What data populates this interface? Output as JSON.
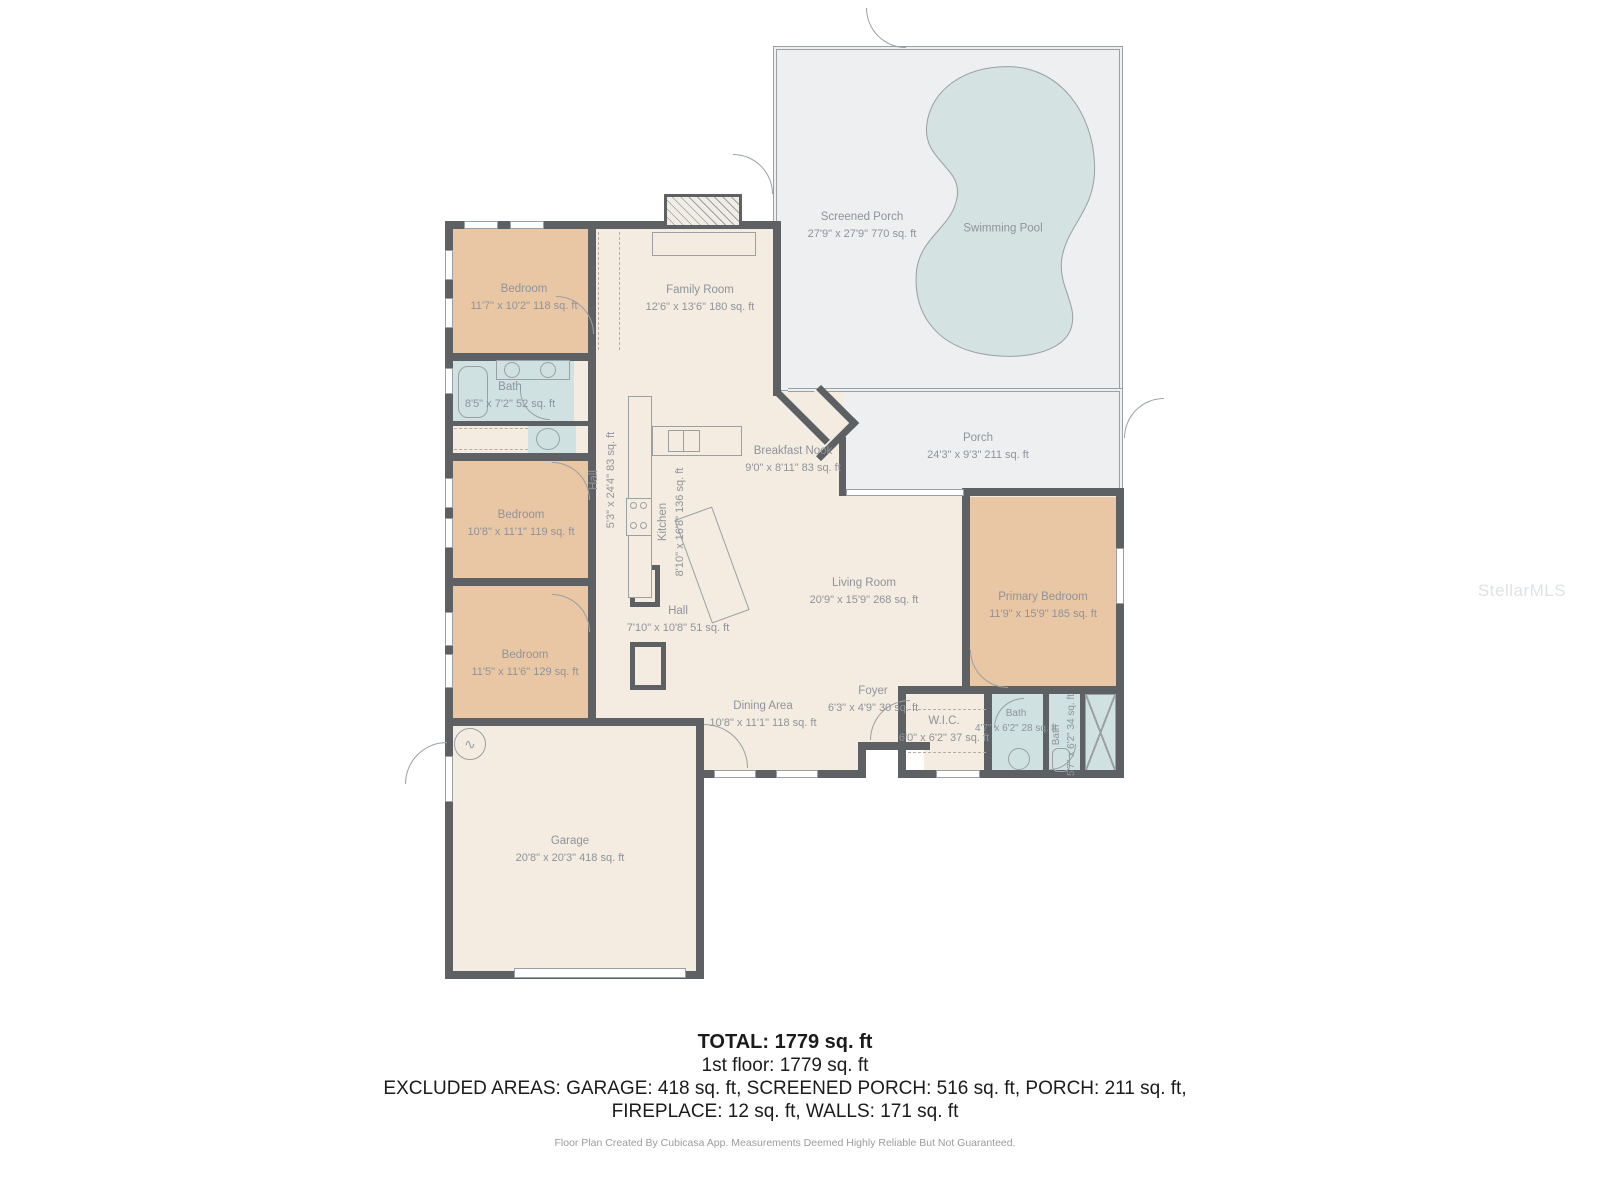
{
  "watermark": "StellarMLS",
  "summary": {
    "total": "TOTAL: 1779 sq. ft",
    "floor1": "1st floor: 1779 sq. ft",
    "excluded_line1": "EXCLUDED AREAS: GARAGE: 418 sq. ft, SCREENED PORCH: 516 sq. ft, PORCH: 211 sq. ft,",
    "excluded_line2": "FIREPLACE: 12 sq. ft, WALLS: 171 sq. ft"
  },
  "footer": "Floor Plan Created By Cubicasa App. Measurements Deemed Highly Reliable But Not Guaranteed.",
  "rooms": [
    {
      "name": "Screened Porch",
      "dims": "27'9\" x 27'9\" 770 sq. ft"
    },
    {
      "name": "Swimming Pool",
      "dims": ""
    },
    {
      "name": "Porch",
      "dims": "24'3\" x 9'3\" 211 sq. ft"
    },
    {
      "name": "Family Room",
      "dims": "12'6\" x 13'6\" 180 sq. ft"
    },
    {
      "name": "Bedroom",
      "dims": "11'7\" x 10'2\" 118 sq. ft"
    },
    {
      "name": "Bath",
      "dims": "8'5\" x 7'2\" 52 sq. ft"
    },
    {
      "name": "Hall",
      "dims": "5'3\" x 24'4\" 83 sq. ft"
    },
    {
      "name": "Kitchen",
      "dims": "8'10\" x 16'8\" 136 sq. ft"
    },
    {
      "name": "Breakfast Nook",
      "dims": "9'0\" x 8'11\" 83 sq. ft"
    },
    {
      "name": "Bedroom",
      "dims": "10'8\" x 11'1\" 119 sq. ft"
    },
    {
      "name": "Bedroom",
      "dims": "11'5\" x 11'6\" 129 sq. ft"
    },
    {
      "name": "Hall",
      "dims": "7'10\" x 10'8\" 51 sq. ft"
    },
    {
      "name": "Living Room",
      "dims": "20'9\" x 15'9\" 268 sq. ft"
    },
    {
      "name": "Primary Bedroom",
      "dims": "11'9\" x 15'9\" 185 sq. ft"
    },
    {
      "name": "Dining Area",
      "dims": "10'8\" x 11'1\" 118 sq. ft"
    },
    {
      "name": "Foyer",
      "dims": "6'3\" x 4'9\" 30 sq. ft"
    },
    {
      "name": "W.I.C.",
      "dims": "6'0\" x 6'2\" 37 sq. ft"
    },
    {
      "name": "Bath",
      "dims": "4'7\" x 6'2\" 28 sq. ft"
    },
    {
      "name": "Bath",
      "dims": "5'7\" x 6'2\" 34 sq. ft"
    },
    {
      "name": "Garage",
      "dims": "20'8\" x 20'3\" 418 sq. ft"
    }
  ],
  "colors": {
    "wall": "#5d6164",
    "floor": "#f4ece1",
    "bedroom": "#eac7a4",
    "bath": "#cfe2e1",
    "porch": "#edeff0",
    "pool_water": "#d5e2e2",
    "label_text": "#8e939a",
    "fixture_line": "#9aa0a3",
    "summary_text": "#1b1b1b",
    "footer_text": "#9b9b9b"
  }
}
